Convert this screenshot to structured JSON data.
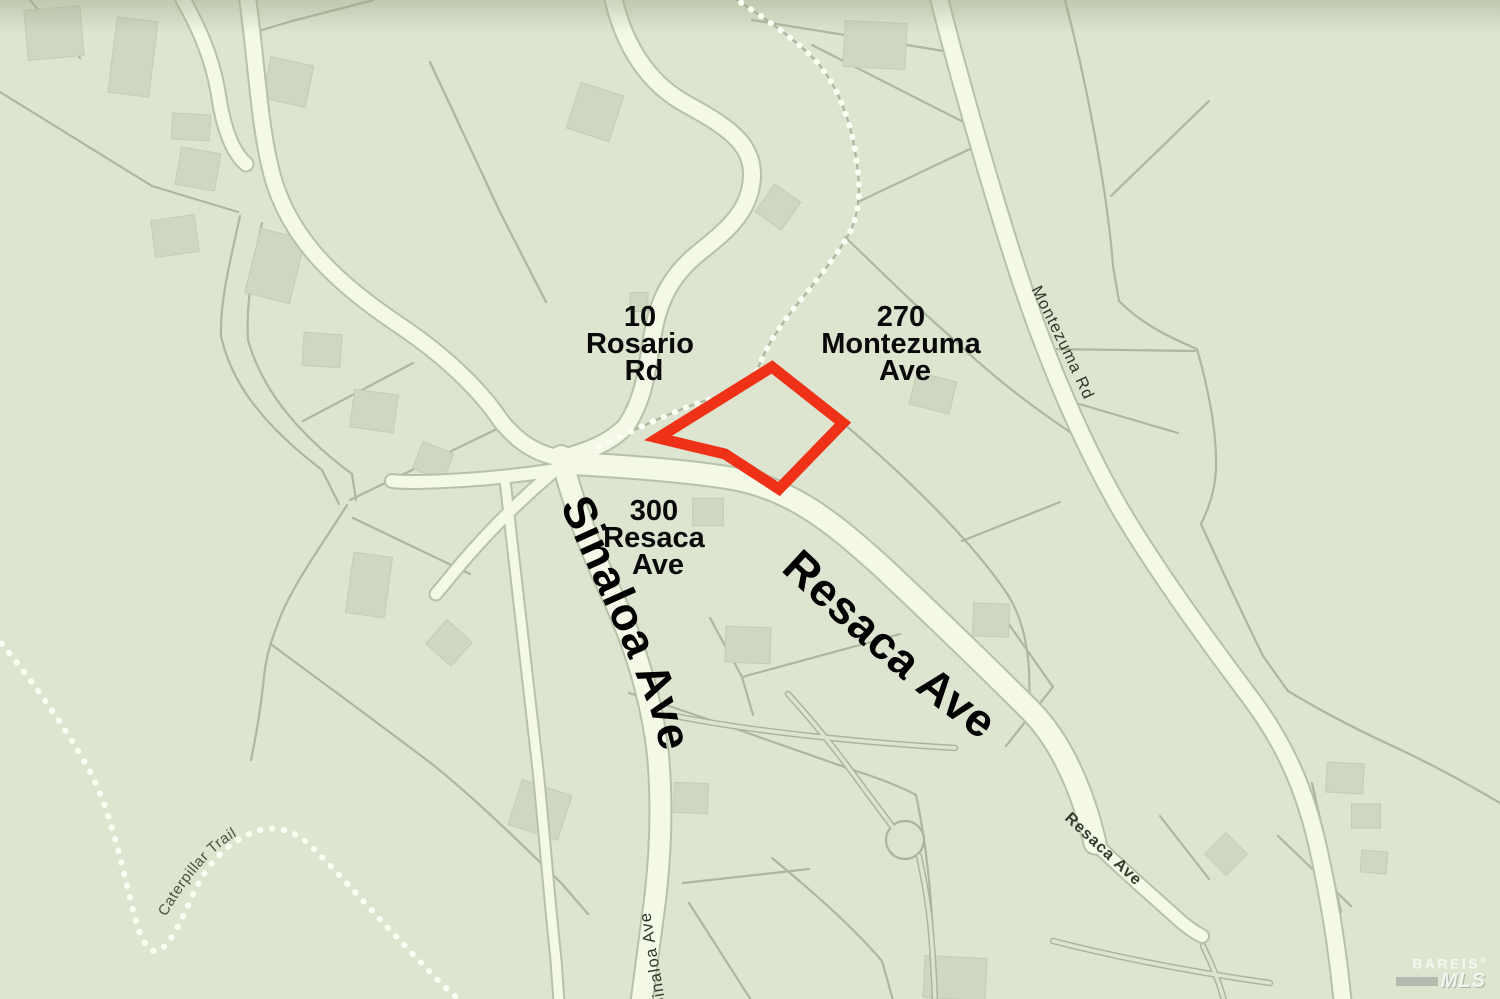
{
  "map": {
    "background_color": "#dde5d1",
    "road_fill_color": "#f3f8e7",
    "parcel_line_color": "#abb7a0",
    "building_color": "#cfd6c2",
    "subject_parcel": {
      "outline_color": "#ee3117",
      "points": "772,367 843,423 779,489 725,454 658,438"
    },
    "parcel_labels": [
      {
        "id": "rosario",
        "lines": [
          "10",
          "Rosario",
          "Rd"
        ]
      },
      {
        "id": "montezuma",
        "lines": [
          "270",
          "Montezuma",
          "Ave"
        ]
      },
      {
        "id": "resaca",
        "lines": [
          "300",
          "Resaca",
          "Ave"
        ]
      }
    ],
    "street_labels": {
      "sinaloa_major": "Sinaloa Ave",
      "resaca_major": "Resaca Ave",
      "montezuma": "Montezuma Rd",
      "resaca_minor": "Resaca Ave",
      "sinaloa_minor": "Sinaloa Ave",
      "caterpillar": "Caterpillar Trail"
    },
    "watermark": {
      "brand": "BAREIS",
      "reg": "®",
      "sub": "MLS"
    }
  }
}
